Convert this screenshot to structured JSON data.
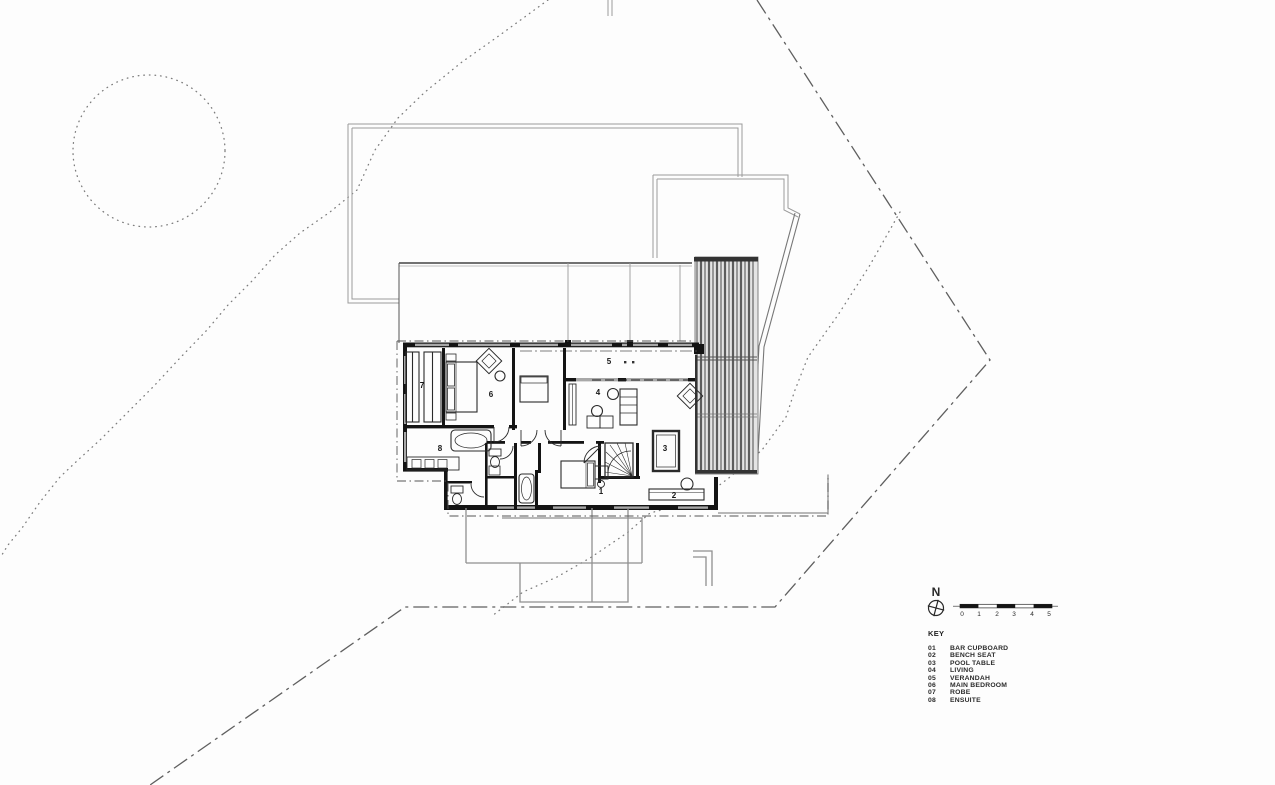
{
  "plan": {
    "room_labels": [
      {
        "num": "1",
        "name": "bar-cupboard"
      },
      {
        "num": "2",
        "name": "bench-seat"
      },
      {
        "num": "3",
        "name": "pool-table"
      },
      {
        "num": "4",
        "name": "living"
      },
      {
        "num": "5",
        "name": "verandah"
      },
      {
        "num": "6",
        "name": "main-bedroom"
      },
      {
        "num": "7",
        "name": "robe"
      },
      {
        "num": "8",
        "name": "ensuite"
      }
    ]
  },
  "north_arrow": {
    "label": "N"
  },
  "scale_bar": {
    "ticks": [
      "0",
      "1",
      "2",
      "3",
      "4",
      "5"
    ]
  },
  "key": {
    "title": "KEY",
    "items": [
      {
        "num": "01",
        "label": "BAR CUPBOARD"
      },
      {
        "num": "02",
        "label": "BENCH SEAT"
      },
      {
        "num": "03",
        "label": "POOL TABLE"
      },
      {
        "num": "04",
        "label": "LIVING"
      },
      {
        "num": "05",
        "label": "VERANDAH"
      },
      {
        "num": "06",
        "label": "MAIN BEDROOM"
      },
      {
        "num": "07",
        "label": "ROBE"
      },
      {
        "num": "08",
        "label": "ENSUITE"
      }
    ]
  },
  "colors": {
    "ink": "#1c1c1c",
    "roof_gray": "#9a9a9a",
    "boundary_gray": "#5f5f5f",
    "window_gray": "#a8a8a8",
    "louvre_fill": "#e4e4e4"
  }
}
